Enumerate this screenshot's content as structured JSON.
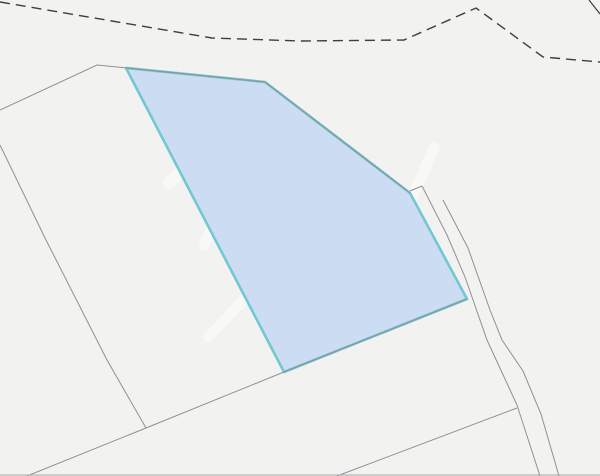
{
  "map": {
    "width": 600,
    "height": 476,
    "background_color": "#f2f2f0",
    "colors": {
      "parcel_fill": "#cbdcf3",
      "parcel_stroke": "#72c8d1",
      "boundary_line": "#8f9092",
      "dashed_line": "#3e3e3e",
      "watermark": "#ffffff",
      "frame_edge": "#a8aaa9"
    },
    "selected_parcel": {
      "points": [
        [
          126,
          68
        ],
        [
          265,
          82
        ],
        [
          410,
          193
        ],
        [
          467,
          299
        ],
        [
          284,
          372
        ]
      ],
      "stroke_width": 2.6
    },
    "boundary_lines": [
      {
        "points": [
          [
            0,
            110
          ],
          [
            97,
            65
          ],
          [
            127,
            68
          ]
        ]
      },
      {
        "points": [
          [
            127,
            68
          ],
          [
            265,
            82
          ],
          [
            410,
            193
          ]
        ]
      },
      {
        "points": [
          [
            410,
            191
          ],
          [
            422,
            186
          ]
        ]
      },
      {
        "points": [
          [
            0,
            145
          ],
          [
            45,
            238
          ],
          [
            107,
            360
          ],
          [
            146,
            428
          ]
        ]
      },
      {
        "points": [
          [
            27,
            476
          ],
          [
            146,
            428
          ],
          [
            284,
            372
          ],
          [
            467,
            299
          ]
        ]
      },
      {
        "points": [
          [
            422,
            186
          ],
          [
            447,
            235
          ],
          [
            465,
            277
          ],
          [
            487,
            340
          ],
          [
            517,
            405
          ],
          [
            540,
            476
          ]
        ]
      },
      {
        "points": [
          [
            443,
            200
          ],
          [
            468,
            248
          ],
          [
            490,
            310
          ],
          [
            502,
            340
          ],
          [
            523,
            371
          ],
          [
            541,
            414
          ],
          [
            559,
            476
          ]
        ]
      },
      {
        "points": [
          [
            337,
            476
          ],
          [
            517,
            408
          ]
        ]
      }
    ],
    "boundary_stroke_width": 1,
    "dashed_boundary": {
      "points": [
        [
          0,
          2
        ],
        [
          212,
          38
        ],
        [
          300,
          41
        ],
        [
          404,
          40
        ],
        [
          476,
          8
        ],
        [
          543,
          57
        ],
        [
          600,
          62
        ]
      ],
      "dash_pattern": "10 6",
      "stroke_width": 1.4
    },
    "corner_segment": {
      "points": [
        [
          589,
          0
        ],
        [
          600,
          14
        ]
      ]
    },
    "frame_bottom": {
      "points": [
        [
          0,
          475
        ],
        [
          600,
          475
        ]
      ]
    },
    "watermark": {
      "opacity": 0.5,
      "elements": [
        {
          "kind": "band",
          "x1": 150,
          "y1": 100,
          "x2": 242,
          "y2": 199,
          "w": 12
        },
        {
          "kind": "band",
          "x1": 222,
          "y1": 130,
          "x2": 169,
          "y2": 183,
          "w": 12
        },
        {
          "kind": "path",
          "d": "M 204,246 C 224,180 354,172 395,240",
          "w": 11
        },
        {
          "kind": "band",
          "x1": 397,
          "y1": 232,
          "x2": 434,
          "y2": 148,
          "w": 11
        },
        {
          "kind": "ring",
          "cx": 290,
          "cy": 250,
          "r": 31,
          "w": 9
        },
        {
          "kind": "band",
          "x1": 290,
          "y1": 246,
          "x2": 290,
          "y2": 215,
          "w": 7
        },
        {
          "kind": "band",
          "x1": 288,
          "y1": 252,
          "x2": 266,
          "y2": 272,
          "w": 7
        },
        {
          "kind": "band",
          "x1": 292,
          "y1": 252,
          "x2": 314,
          "y2": 272,
          "w": 7
        },
        {
          "kind": "path",
          "d": "M 284,231 A 9 9 0 1 0 284,250",
          "w": 5
        },
        {
          "kind": "path",
          "d": "M 296,231 A 9 9 0 1 1 296,250",
          "w": 5
        },
        {
          "kind": "band",
          "x1": 307,
          "y1": 289,
          "x2": 317,
          "y2": 348,
          "w": 10
        },
        {
          "kind": "band",
          "x1": 262,
          "y1": 281,
          "x2": 208,
          "y2": 337,
          "w": 10
        },
        {
          "kind": "band",
          "x1": 321,
          "y1": 268,
          "x2": 356,
          "y2": 306,
          "w": 10
        },
        {
          "kind": "shield",
          "d": "M 266,284 h 24 v 12 q 0 11 -12 15 q -12 -4 -12 -15 z"
        }
      ]
    }
  }
}
